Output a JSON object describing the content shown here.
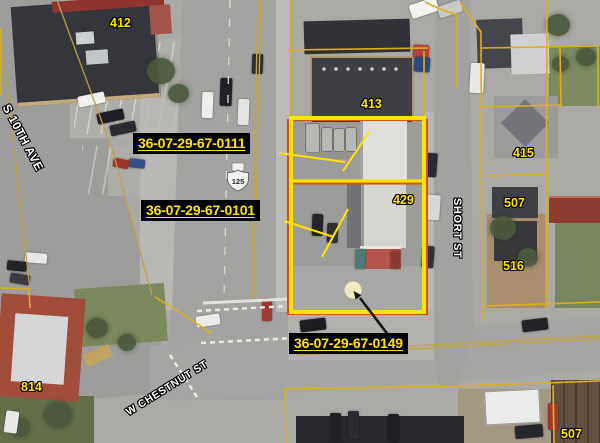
{
  "map_type": "aerial-parcel-map",
  "parcel_labels": [
    {
      "text": "36-07-29-67-0111"
    },
    {
      "text": "36-07-29-67-0101"
    },
    {
      "text": "36-07-29-67-0149"
    }
  ],
  "address_labels": [
    {
      "text": "412"
    },
    {
      "text": "413"
    },
    {
      "text": "415"
    },
    {
      "text": "429"
    },
    {
      "text": "507"
    },
    {
      "text": "516"
    },
    {
      "text": "814"
    },
    {
      "text": "507"
    }
  ],
  "street_labels": [
    {
      "name": "S 10TH AVE"
    },
    {
      "name": "SHORT ST"
    },
    {
      "name": "W CHESTNUT ST"
    }
  ],
  "route_shield": {
    "type": "us-route",
    "number": "125"
  },
  "selected_parcel_marker": {
    "shape": "circle",
    "color": "#f1ebc2"
  },
  "colors": {
    "highlight": "#ffe400",
    "parcel-line": "#dcaf1e",
    "selected-outline": "#cf5500",
    "label-bg": "#000000",
    "street-label": "#ffffff"
  }
}
